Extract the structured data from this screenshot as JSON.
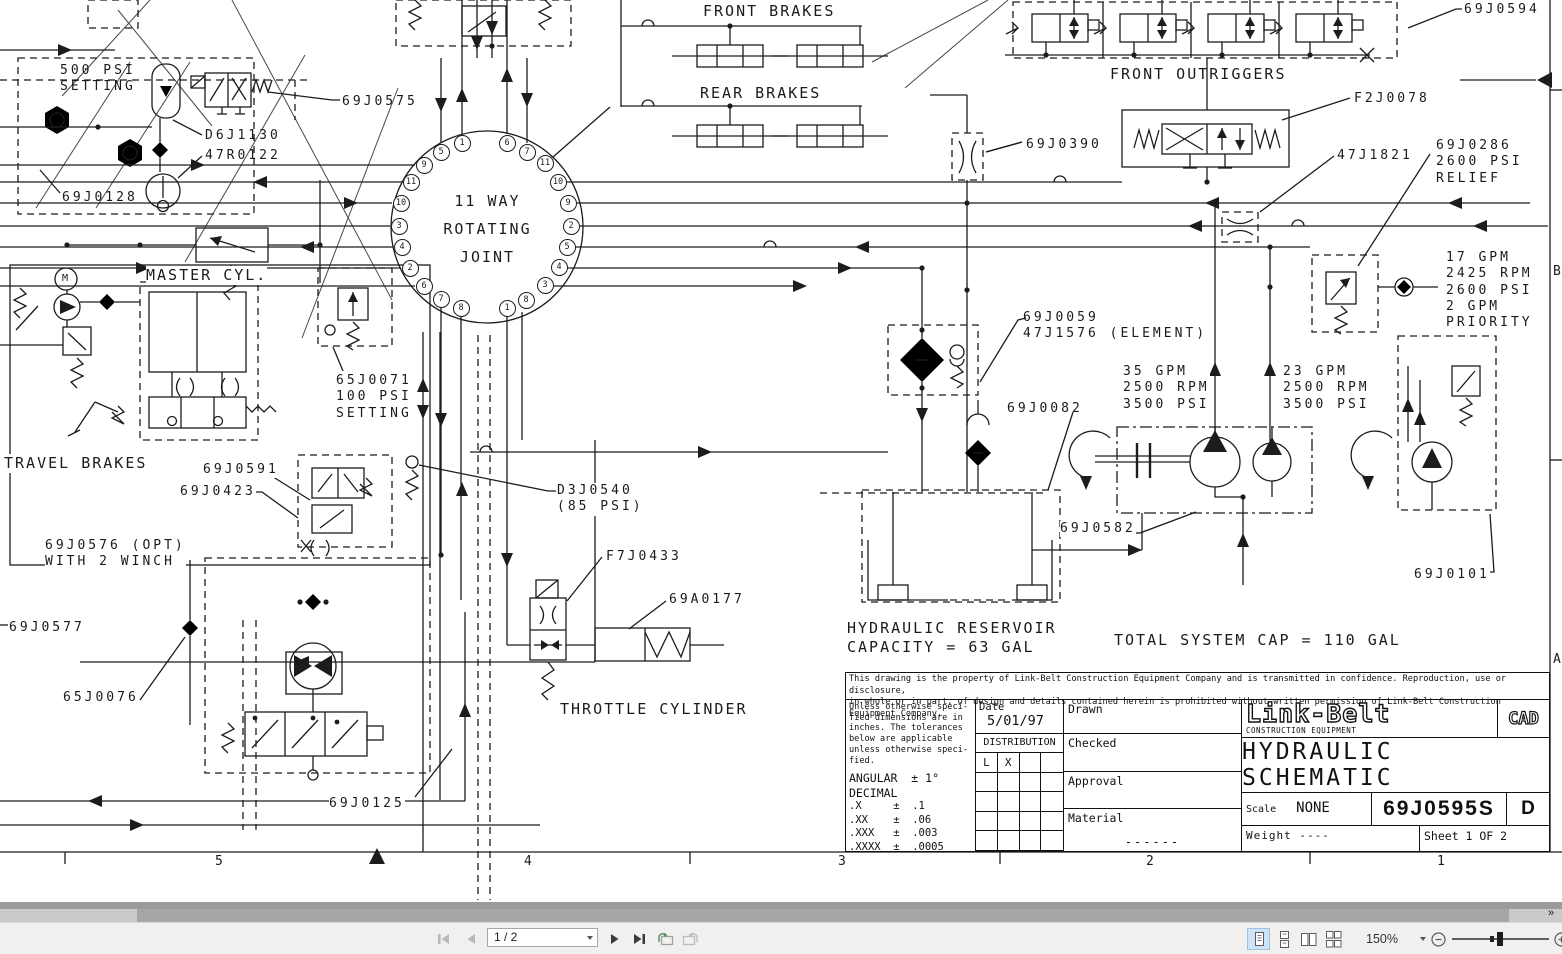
{
  "drawing": {
    "labels": {
      "front_brakes": "FRONT BRAKES",
      "rear_brakes": "REAR BRAKES",
      "front_outriggers": "FRONT OUTRIGGERS",
      "p69J0594": "69J0594",
      "pF2J0078": "F2J0078",
      "p69J0390": "69J0390",
      "p47J1821": "47J1821",
      "p69J0286": "69J0286\n2600 PSI\nRELIEF",
      "gpm17": "17 GPM\n2425 RPM\n2600 PSI\n2 GPM\nPRIORITY",
      "setting500": "500 PSI\nSETTING",
      "p69J0575": "69J0575",
      "pD6J1130": "D6J1130",
      "p47R0122": "47R0122",
      "p69J0128": "69J0128",
      "master_cyl": "MASTER CYL.",
      "p65J0071": "65J0071\n100 PSI\nSETTING",
      "travel_brakes": "TRAVEL BRAKES",
      "p69J0591": "69J0591",
      "p69J0423": "69J0423",
      "pD3J0540": "D3J0540\n(85 PSI)",
      "p69J0576": "69J0576 (OPT)\nWITH 2 WINCH",
      "p69J0577": "69J0577",
      "p65J0076": "65J0076",
      "pF7J0433": "F7J0433",
      "p69A0177": "69A0177",
      "throttle_cylinder": "THROTTLE CYLINDER",
      "p69J0125": "69J0125",
      "p69J0059": "69J0059\n47J1576 (ELEMENT)",
      "p69J0082": "69J0082",
      "gpm35": "35 GPM\n2500 RPM\n3500 PSI",
      "gpm23": "23 GPM\n2500 RPM\n3500 PSI",
      "p69J0582": "69J0582",
      "p69J0101": "69J0101",
      "reservoir": "HYDRAULIC RESERVOIR\nCAPACITY = 63 GAL",
      "total_cap": "TOTAL SYSTEM CAP = 110 GAL",
      "motor_m": "M"
    },
    "joint": {
      "title": "11 WAY\nROTATING\nJOINT",
      "ports": [
        {
          "n": "1",
          "x": 462,
          "y": 143
        },
        {
          "n": "6",
          "x": 507,
          "y": 143
        },
        {
          "n": "5",
          "x": 441,
          "y": 152
        },
        {
          "n": "7",
          "x": 527,
          "y": 152
        },
        {
          "n": "9",
          "x": 424,
          "y": 165
        },
        {
          "n": "11",
          "x": 545,
          "y": 163
        },
        {
          "n": "11",
          "x": 411,
          "y": 182
        },
        {
          "n": "10",
          "x": 558,
          "y": 182
        },
        {
          "n": "10",
          "x": 401,
          "y": 203
        },
        {
          "n": "9",
          "x": 568,
          "y": 203
        },
        {
          "n": "3",
          "x": 399,
          "y": 226
        },
        {
          "n": "2",
          "x": 571,
          "y": 226
        },
        {
          "n": "4",
          "x": 402,
          "y": 247
        },
        {
          "n": "5",
          "x": 567,
          "y": 247
        },
        {
          "n": "2",
          "x": 410,
          "y": 268
        },
        {
          "n": "4",
          "x": 559,
          "y": 267
        },
        {
          "n": "6",
          "x": 424,
          "y": 286
        },
        {
          "n": "3",
          "x": 545,
          "y": 285
        },
        {
          "n": "7",
          "x": 441,
          "y": 299
        },
        {
          "n": "8",
          "x": 526,
          "y": 300
        },
        {
          "n": "8",
          "x": 461,
          "y": 308
        },
        {
          "n": "1",
          "x": 507,
          "y": 308
        }
      ]
    },
    "zones": {
      "bottom": [
        {
          "t": "5",
          "x": 215
        },
        {
          "t": "4",
          "x": 524
        },
        {
          "t": "3",
          "x": 838
        },
        {
          "t": "2",
          "x": 1146
        },
        {
          "t": "1",
          "x": 1437
        }
      ],
      "right": [
        {
          "t": "B",
          "y": 264
        },
        {
          "t": "A",
          "y": 652
        }
      ]
    }
  },
  "title_block": {
    "notice_line1": "This drawing is the property of Link-Belt Construction Equipment Company and is transmitted in confidence. Reproduction, use or disclosure,",
    "notice_line2": "in whole or in part, of design and details contained herein is prohibited without written permission of Link-Belt Construction Equipment Company,",
    "tolerance_note": "Unless otherwise speci-\nfied dimensions are in\ninches. The tolerances\nbelow are applicable\nunless otherwise speci-\nfied.",
    "angular": "ANGULAR  ± 1°",
    "decimal": "DECIMAL",
    "tols": [
      ".X     ±  .1",
      ".XX    ±  .06",
      ".XXX   ±  .003",
      ".XXXX  ±  .0005"
    ],
    "date_label": "Date",
    "date_value": "5/01/97",
    "distribution_label": "DISTRIBUTION",
    "dist": [
      "L",
      "X"
    ],
    "drawn_label": "Drawn",
    "checked_label": "Checked",
    "approval_label": "Approval",
    "material_label": "Material",
    "material_value": "------",
    "brand": "Link-Belt",
    "brand_sub": "CONSTRUCTION EQUIPMENT",
    "cad": "CAD",
    "title": "HYDRAULIC SCHEMATIC",
    "scale_label": "Scale",
    "scale_value": "NONE",
    "drawing_number": "69J0595S",
    "size_letter": "D",
    "weight_label": "Weight",
    "weight_value": "----",
    "sheet": "Sheet 1 OF 2"
  },
  "viewer": {
    "page_display": "1 / 2",
    "zoom_display": "150%",
    "scroll_corner_glyph": "»"
  }
}
